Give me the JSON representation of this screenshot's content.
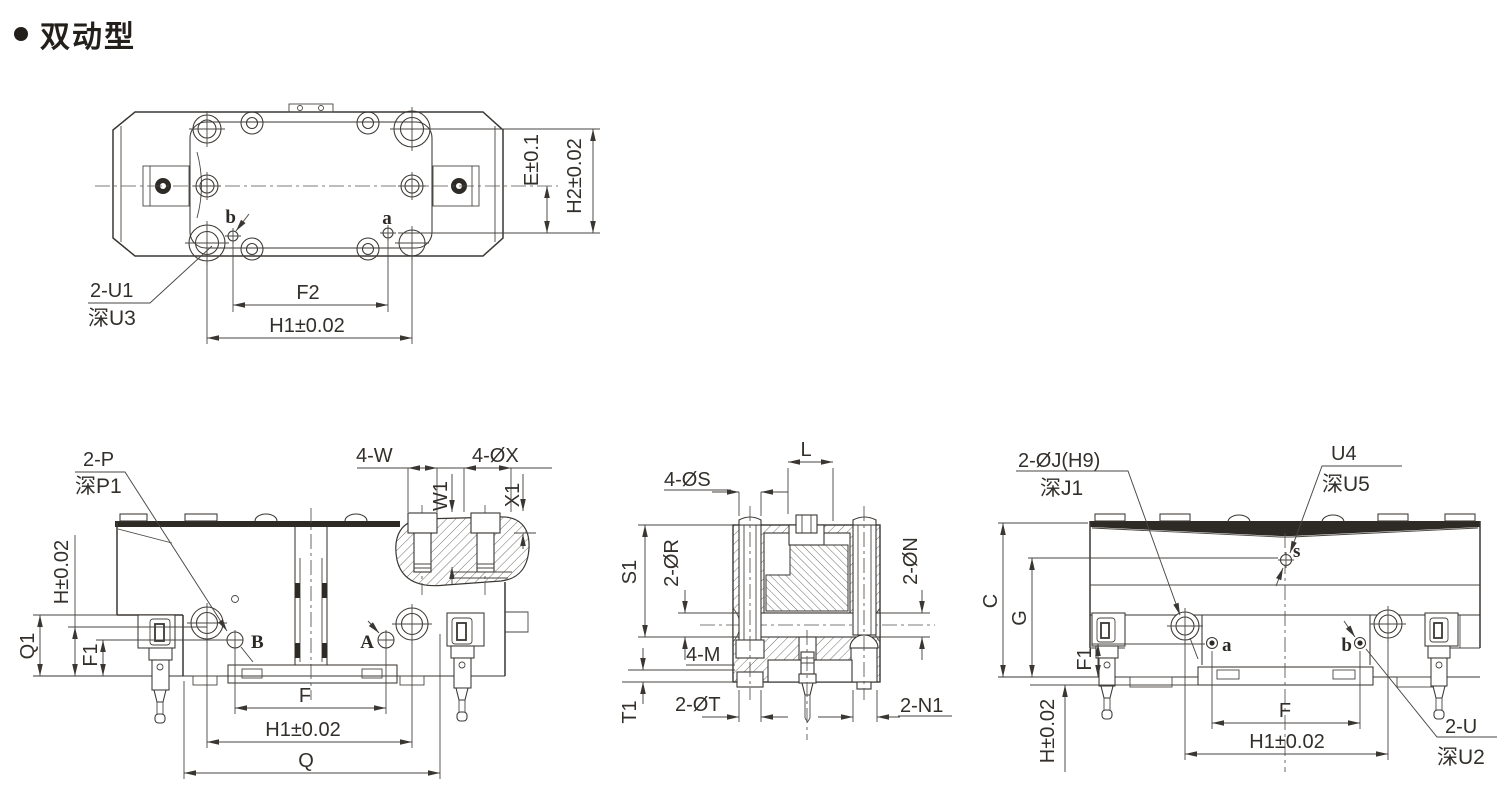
{
  "title": {
    "text": "双动型"
  },
  "top_view": {
    "e": "E±0.1",
    "h2": "H2±0.02",
    "f2": "F2",
    "h1": "H1±0.02",
    "u1": "2-U1",
    "u3": "深U3",
    "a": "a",
    "b": "b"
  },
  "front_view": {
    "p": "2-P",
    "p1": "深P1",
    "w4": "4-W",
    "x4": "4-ØX",
    "w1": "W1",
    "x1": "X1",
    "q1": "Q1",
    "h": "H±0.02",
    "f1": "F1",
    "f": "F",
    "h1": "H1±0.02",
    "q": "Q",
    "A": "A",
    "B": "B"
  },
  "section_view": {
    "l": "L",
    "s4": "4-ØS",
    "r2": "2-ØR",
    "s1": "S1",
    "m4": "4-M",
    "t1": "T1",
    "t2": "2-ØT",
    "n2": "2-ØN",
    "n12": "2-N1"
  },
  "side_view": {
    "j": "2-ØJ(H9)",
    "j1": "深J1",
    "u4": "U4",
    "u5": "深U5",
    "c": "C",
    "g": "G",
    "f1": "F1",
    "h": "H±0.02",
    "f": "F",
    "h1": "H1±0.02",
    "u": "2-U",
    "u2": "深U2",
    "a": "a",
    "b": "b",
    "s": "s"
  }
}
